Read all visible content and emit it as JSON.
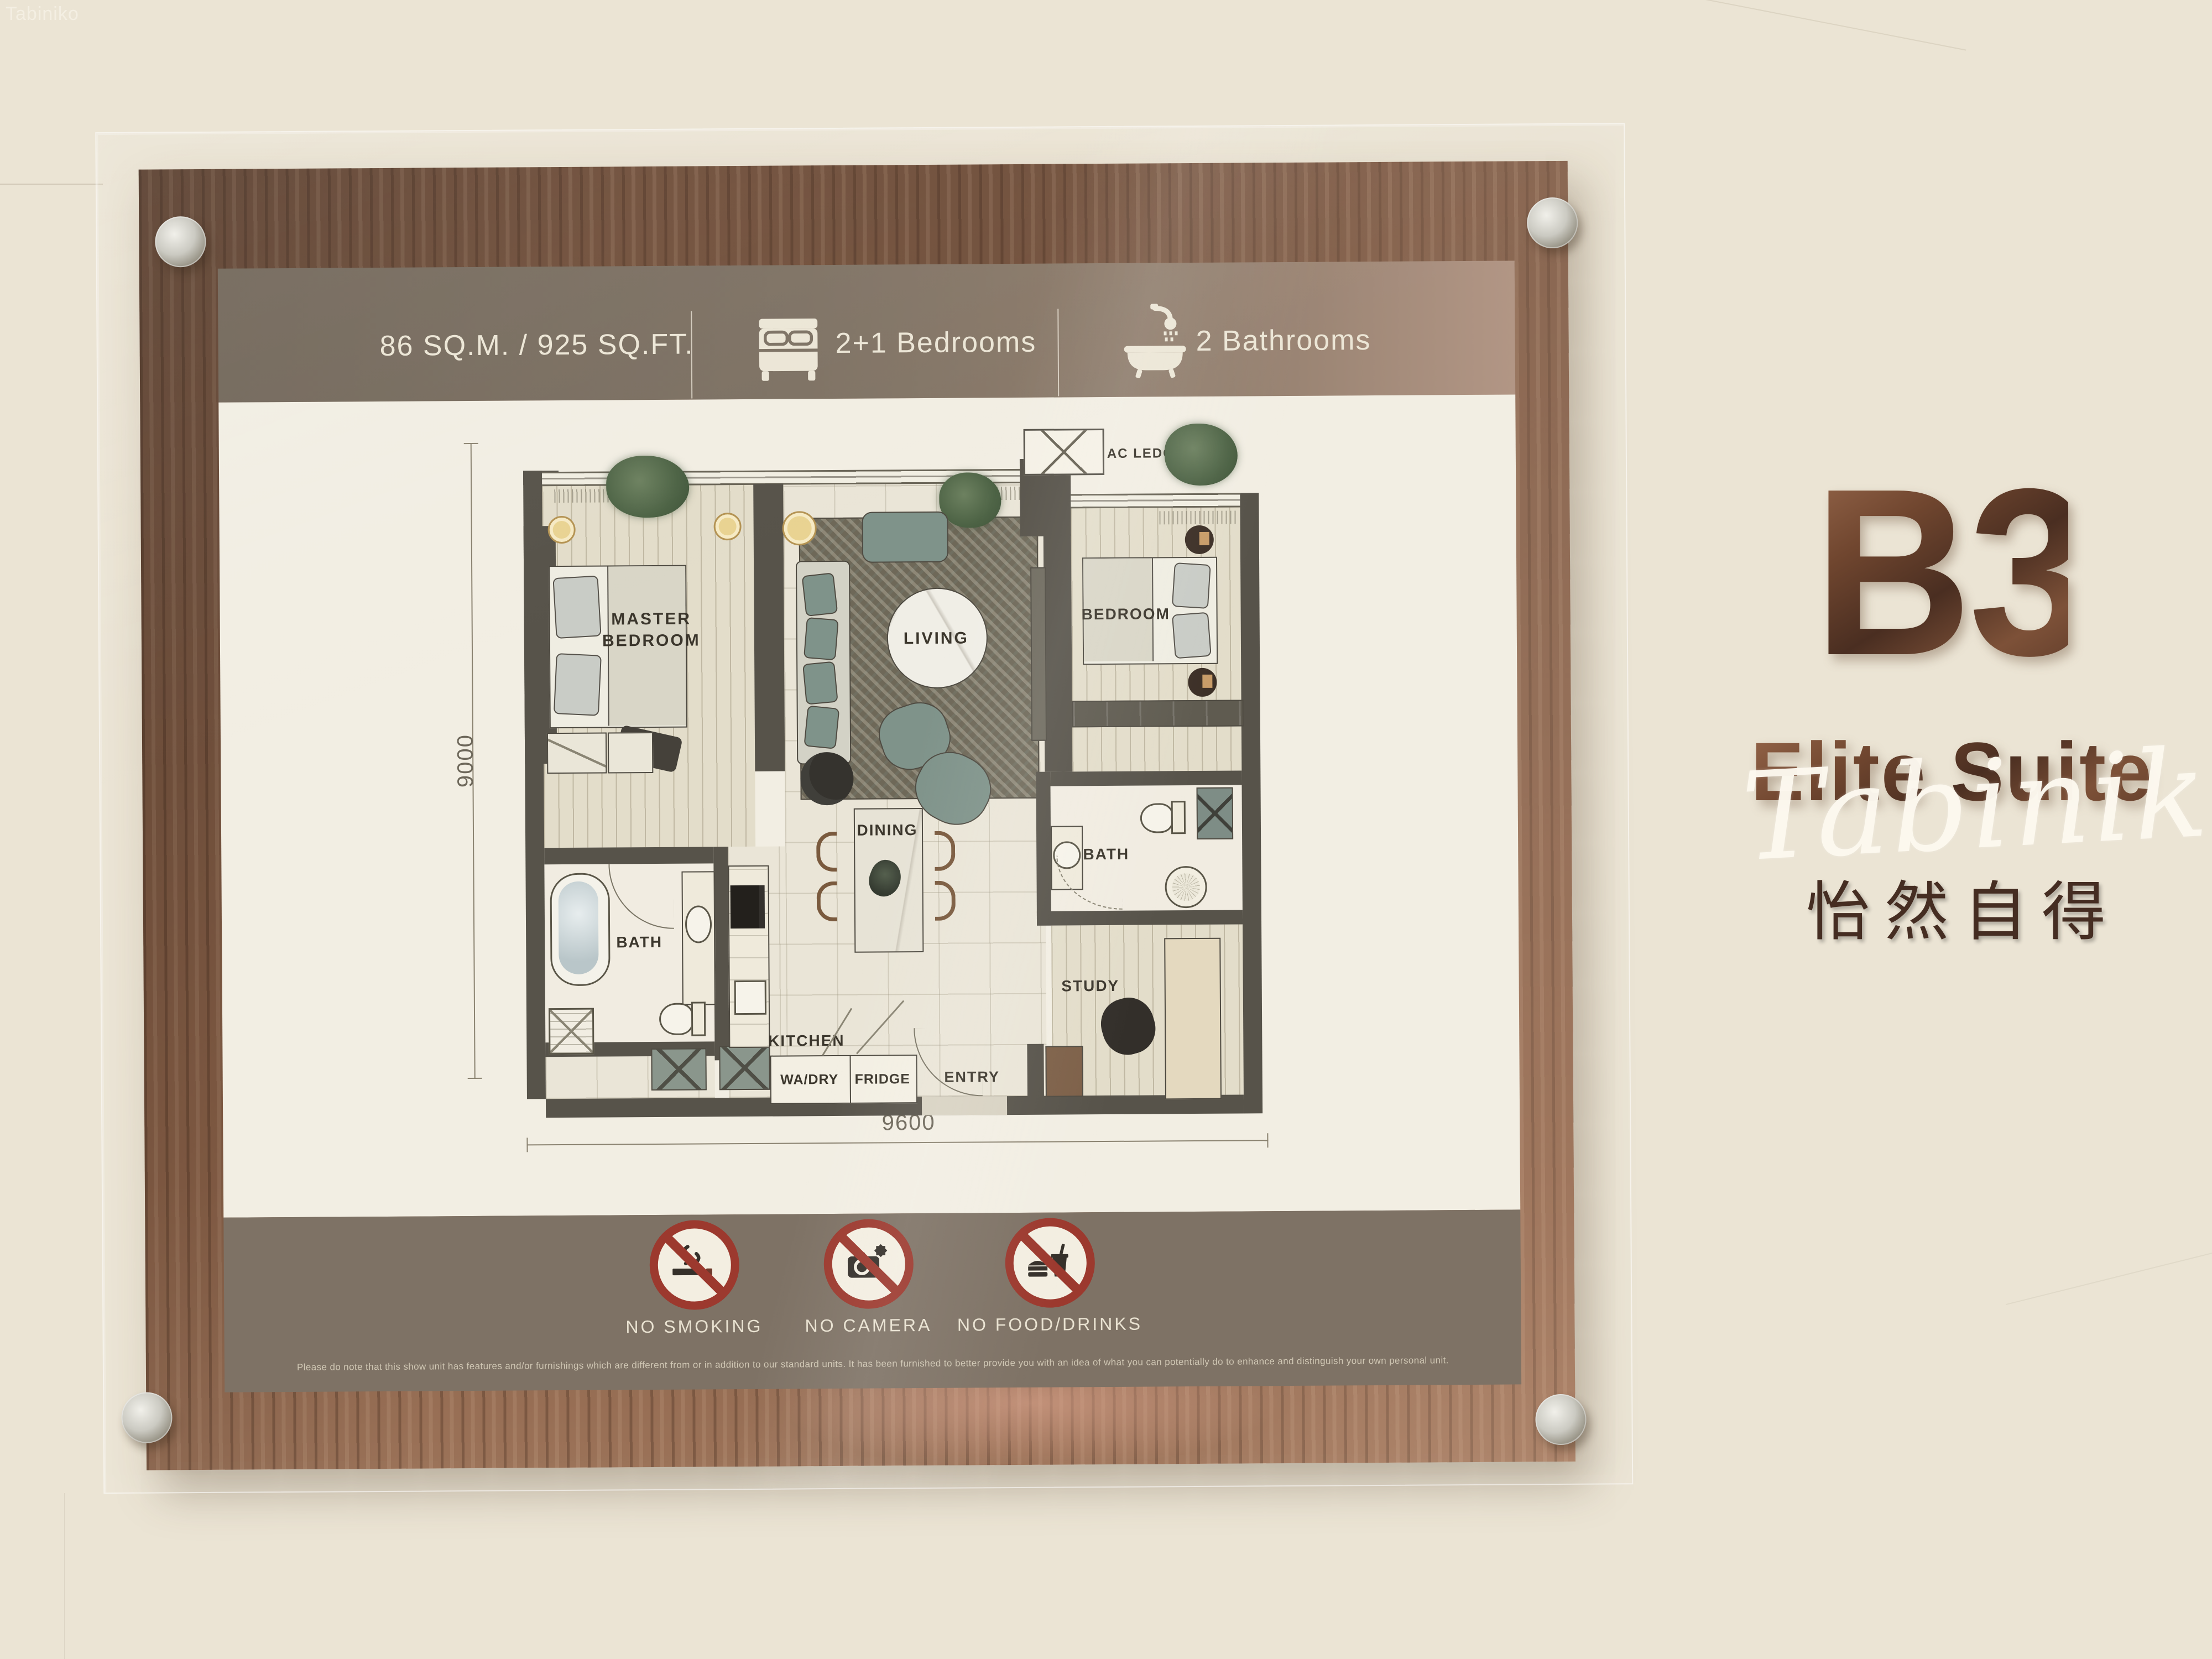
{
  "photo_watermark": {
    "corner_text": "Tabiniko",
    "script_text": "Tabiniko"
  },
  "board": {
    "header": {
      "area": "86 SQ.M. / 925 SQ.FT.",
      "bedrooms": "2+1 Bedrooms",
      "bathrooms": "2 Bathrooms"
    },
    "floor_plan": {
      "rooms": {
        "master_bedroom": "MASTER BEDROOM",
        "living": "LIVING",
        "bedroom": "BEDROOM",
        "dining": "DINING",
        "kitchen": "KITCHEN",
        "bath_master": "BATH",
        "bath_common": "BATH",
        "study": "STUDY",
        "entry": "ENTRY",
        "wa_dry": "WA/DRY",
        "fridge": "FRIDGE",
        "ac_ledge": "AC LEDGE"
      },
      "dimensions": {
        "width_mm": "9600",
        "depth_mm": "9000"
      }
    },
    "rules": [
      {
        "icon": "no-smoking-icon",
        "label": "NO SMOKING"
      },
      {
        "icon": "no-camera-icon",
        "label": "NO CAMERA"
      },
      {
        "icon": "no-food-drinks-icon",
        "label": "NO FOOD/DRINKS"
      }
    ],
    "disclaimer": "Please do note that this show unit has features and/or furnishings which are different from or in addition to our standard units. It has been furnished to better provide you with an idea of what you can potentially do to enhance and distinguish your own personal unit."
  },
  "signage": {
    "unit_code": "B3",
    "unit_name": "Elite Suite",
    "unit_tagline_cn": "怡然自得"
  },
  "colors": {
    "bronze": "#6b4534",
    "prohibition_red": "#9c392e",
    "header_taupe": "#7d7264",
    "wood_frame": "#7b5742",
    "plan_wall": "#57534a",
    "teal_furniture": "#7f938a",
    "accent_yellow": "#e9d392"
  }
}
